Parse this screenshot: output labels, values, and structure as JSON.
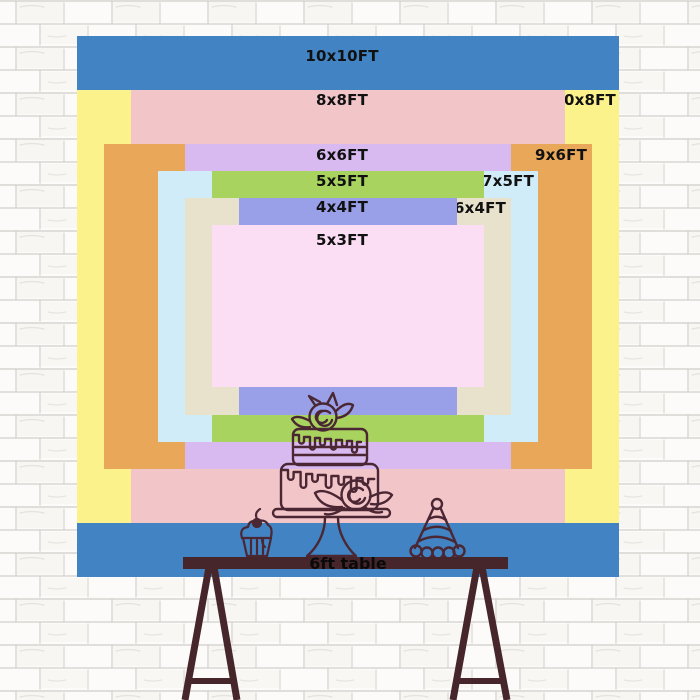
{
  "backdrop": {
    "title_note": "nested size comparison rectangles",
    "text_color": "#111111",
    "sizes": [
      {
        "label": "10x10FT",
        "width_ft": 10,
        "height_ft": 10,
        "color": "#4183c3",
        "label_placement": "center"
      },
      {
        "label": "10x8FT",
        "width_ft": 10,
        "height_ft": 8,
        "color": "#fcf28c",
        "label_placement": "right"
      },
      {
        "label": "8x8FT",
        "width_ft": 8,
        "height_ft": 8,
        "color": "#f2c5c9",
        "label_placement": "center"
      },
      {
        "label": "9x6FT",
        "width_ft": 9,
        "height_ft": 6,
        "color": "#e9a75a",
        "label_placement": "right"
      },
      {
        "label": "6x6FT",
        "width_ft": 6,
        "height_ft": 6,
        "color": "#d8baf1",
        "label_placement": "center"
      },
      {
        "label": "7x5FT",
        "width_ft": 7,
        "height_ft": 5,
        "color": "#cfecf8",
        "label_placement": "right"
      },
      {
        "label": "5x5FT",
        "width_ft": 5,
        "height_ft": 5,
        "color": "#a8d35e",
        "label_placement": "center"
      },
      {
        "label": "6x4FT",
        "width_ft": 6,
        "height_ft": 4,
        "color": "#e8e1cc",
        "label_placement": "right"
      },
      {
        "label": "4x4FT",
        "width_ft": 4,
        "height_ft": 4,
        "color": "#9aa0e8",
        "label_placement": "center"
      },
      {
        "label": "5x3FT",
        "width_ft": 5,
        "height_ft": 3,
        "color": "#fcdef4",
        "label_placement": "center"
      }
    ]
  },
  "table": {
    "label": "6ft table",
    "color": "#47262b",
    "label_color": "#0a0a0a"
  },
  "illustration": {
    "line_color": "#4a2733",
    "items": [
      "tiered-cake",
      "cupcake",
      "party-hat"
    ]
  },
  "wall": {
    "style": "white-brick",
    "background": "#fcfbf9",
    "mortar_line_color": "#a8a5a0"
  }
}
